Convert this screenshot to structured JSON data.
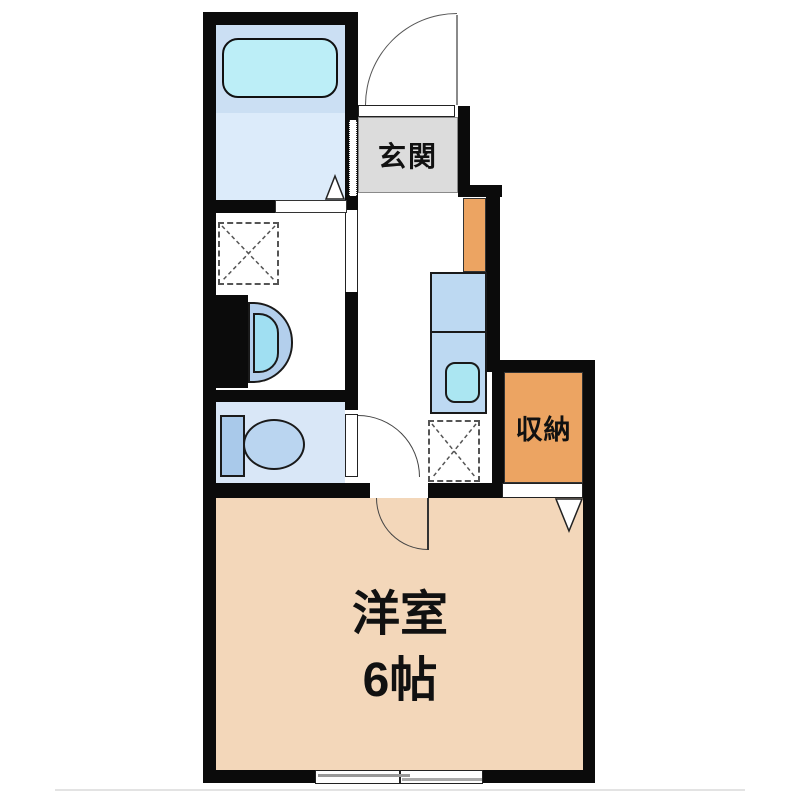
{
  "floorplan": {
    "labels": {
      "genkan": "玄関",
      "storage": "収納",
      "room_name": "洋室",
      "room_size": "6帖"
    },
    "fixtures": [
      "entrance-door",
      "bathtub",
      "bath-folding-door-marker",
      "washing-machine-space",
      "washbasin",
      "sliding-door",
      "toilet",
      "toilet-door",
      "kitchen-counter",
      "kitchen-sink",
      "refrigerator-space",
      "storage-opening",
      "storage-door-marker",
      "room-door",
      "sliding-window"
    ],
    "colors": {
      "wall": "#0b0b0b",
      "room-fill": "#f3d7ba",
      "storage-fill": "#eca462",
      "genkan-fill": "#dcdcdc",
      "bath-upper": "#cbdff3",
      "bath-lower": "#dcebfa",
      "toilet-floor": "#d9e7f7",
      "bathtub-fill": "#bceef7",
      "counter-fill": "#bdd9f2",
      "sink-fill": "#abe6f2",
      "tank-fill": "#a9c9ea",
      "bowl-fill": "#bad5f0",
      "basin-outer": "#b3cfec",
      "basin-inner": "#a0dff2"
    }
  }
}
